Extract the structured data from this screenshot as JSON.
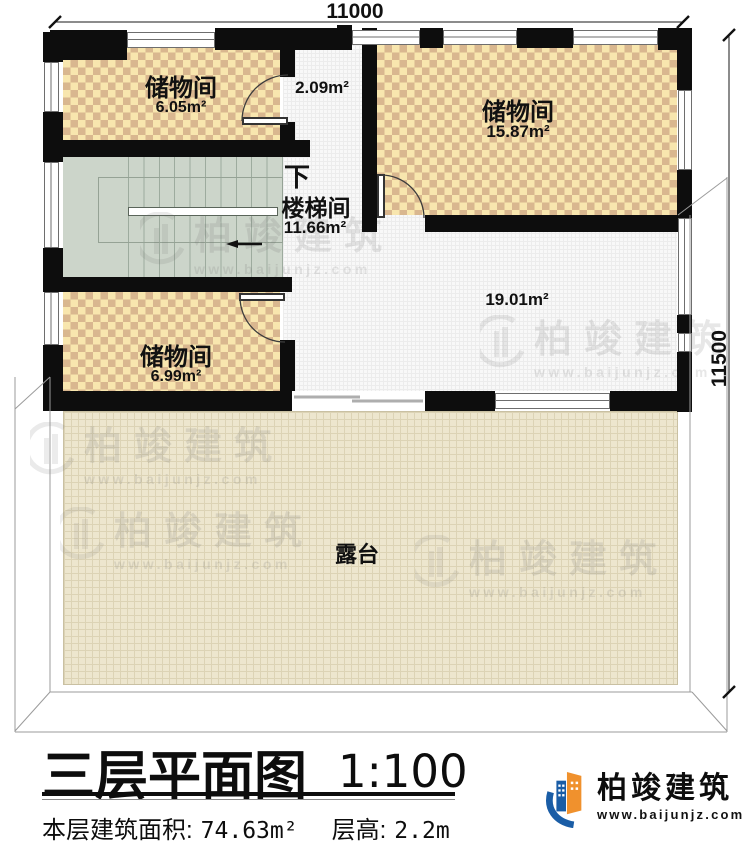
{
  "plan": {
    "dim_top": "11000",
    "dim_right": "11500",
    "rooms": {
      "storage1": {
        "name": "储物间",
        "area": "6.05m²"
      },
      "corridor": {
        "area": "2.09m²"
      },
      "storage2": {
        "name": "储物间",
        "area": "15.87m²"
      },
      "stair": {
        "name": "楼梯间",
        "area": "11.66m²",
        "down": "下"
      },
      "storage3": {
        "name": "储物间",
        "area": "6.99m²"
      },
      "hall": {
        "area": "19.01m²"
      },
      "terrace": {
        "name": "露台"
      }
    }
  },
  "title_block": {
    "title": "三层平面图",
    "scale": "1:100",
    "area_label": "本层建筑面积:",
    "area_value": "74.63m²",
    "height_label": "层高:",
    "height_value": "2.2m"
  },
  "branding": {
    "company": "柏竣建筑",
    "website": "www.baijunjz.com"
  },
  "watermark": {
    "company": "柏竣建筑",
    "website": "www.baijunjz.com"
  },
  "colors": {
    "wall": "#0d0d0d",
    "checker_light": "#f8e6ae",
    "checker_dark": "#d9b78f",
    "stairs": "#ccd5ca",
    "terrace": "#ede6ce",
    "hall_grid": "#f8f8f8",
    "logo_blue": "#1a5da6",
    "logo_orange": "#f0912d"
  }
}
